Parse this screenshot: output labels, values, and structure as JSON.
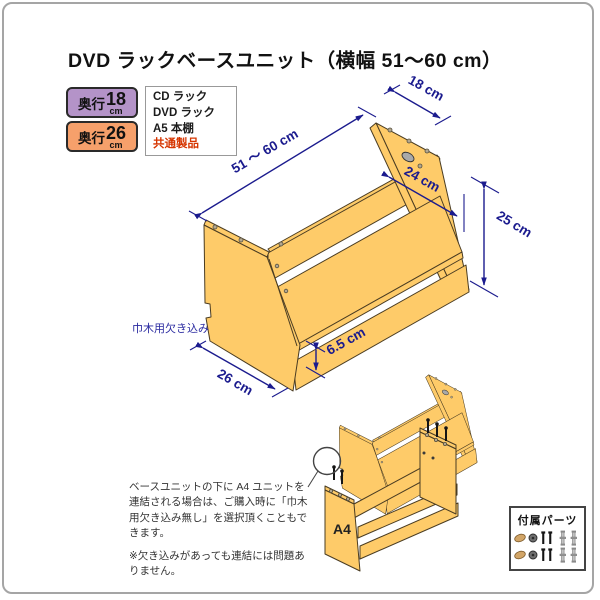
{
  "page": {
    "title": "DVD ラックベースユニット（横幅 51～60 cm）"
  },
  "legend": {
    "badge_18": {
      "prefix": "奥行",
      "value": "18",
      "unit": "cm"
    },
    "badge_26": {
      "prefix": "奥行",
      "value": "26",
      "unit": "cm"
    },
    "products": [
      {
        "label": "CD ラック"
      },
      {
        "label": "DVD ラック"
      },
      {
        "label": "A5 本棚"
      },
      {
        "label": "共通製品"
      }
    ]
  },
  "diagram": {
    "dims": {
      "width": "51 ～ 60 cm",
      "top_depth": "18 cm",
      "shelf_depth": "24 cm",
      "height": "25 cm",
      "kick_height": "6.5 cm",
      "bottom_depth": "26 cm"
    },
    "notch_label": "巾木用欠き込み"
  },
  "connection_note": {
    "p1": [
      "ベースユニットの下に A4 ユニットを",
      "連結される場合は、ご購入時に「巾木",
      "用欠き込み無し」を選択頂くこともで",
      "きます。"
    ],
    "p2": [
      "※欠き込みがあっても連結には問題あ",
      "りません。"
    ],
    "unit_label": "A4"
  },
  "parts_box": {
    "title": "付属パーツ"
  },
  "colors": {
    "wood": "#FECB69",
    "wood_outline": "#4a3c22",
    "dimension_navy": "#1b1b8e",
    "badge_18_purple": "#b493c8",
    "badge_26_orange": "#f6a06b",
    "common_products_red": "#d63500"
  }
}
